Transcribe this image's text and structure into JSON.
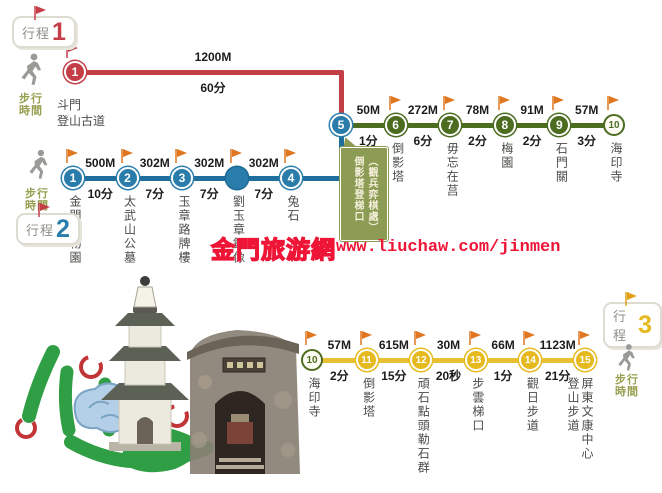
{
  "labels": {
    "route_prefix": "行程",
    "walk_time": "步行時間"
  },
  "colors": {
    "route1_red": "#c43e48",
    "route2_blue": "#2a7dab",
    "summit_green": "#4c6c20",
    "route3_yellow": "#e6ba1e",
    "flag_orange": "#e0761f",
    "walk_label_olive": "#97a050",
    "callout_olive": "#8c9c55",
    "watermark_red": "#ee1537"
  },
  "watermark": {
    "site": "金門旅游網",
    "url": "www.liuchaw.com/jinmen"
  },
  "route1": {
    "number": "1",
    "stop": {
      "number": "1",
      "name": "斗門\n登山古道"
    },
    "segment": {
      "distance": "1200M",
      "time": "60分"
    }
  },
  "route2": {
    "number": "2",
    "stops": [
      {
        "number": "1",
        "name": "金門植物園"
      },
      {
        "number": "2",
        "name": "太武山公墓"
      },
      {
        "number": "3",
        "name": "玉章路牌樓"
      },
      {
        "number": "",
        "style": "bluesolid",
        "name": "劉玉章銅像"
      },
      {
        "number": "4",
        "name": "兔石"
      }
    ],
    "segments": [
      {
        "distance": "500M",
        "time": "10分"
      },
      {
        "distance": "302M",
        "time": "7分"
      },
      {
        "distance": "302M",
        "time": "7分"
      },
      {
        "distance": "302M",
        "time": "7分"
      }
    ]
  },
  "summit_row": {
    "stops": [
      {
        "number": "5",
        "style": "blue",
        "flag": false,
        "name": ""
      },
      {
        "number": "6",
        "style": "green",
        "name": "倒影塔"
      },
      {
        "number": "7",
        "style": "green",
        "name": "毋忘在莒"
      },
      {
        "number": "8",
        "style": "green",
        "name": "梅園"
      },
      {
        "number": "9",
        "style": "green",
        "name": "石門關"
      },
      {
        "number": "10",
        "style": "outline",
        "name": "海印寺"
      }
    ],
    "segments": [
      {
        "distance": "50M",
        "time": "1分"
      },
      {
        "distance": "272M",
        "time": "6分"
      },
      {
        "distance": "78M",
        "time": "2分"
      },
      {
        "distance": "91M",
        "time": "2分"
      },
      {
        "distance": "57M",
        "time": "3分"
      }
    ],
    "callout": "（觀兵弈棋處）\n倒影塔登梯口"
  },
  "route3": {
    "number": "3",
    "stops": [
      {
        "number": "10",
        "style": "outline",
        "name": "海印寺"
      },
      {
        "number": "11",
        "style": "yellow",
        "name": "倒影塔"
      },
      {
        "number": "12",
        "style": "yellow",
        "name": "頑石點頭勒石群"
      },
      {
        "number": "13",
        "style": "yellow",
        "name": "步雲梯口"
      },
      {
        "number": "14",
        "style": "yellow",
        "name": "觀日步道"
      },
      {
        "number": "15",
        "style": "yellow",
        "name": "屏東文康中心\n登山步道"
      }
    ],
    "segments": [
      {
        "distance": "57M",
        "time": "2分"
      },
      {
        "distance": "615M",
        "time": "15分"
      },
      {
        "distance": "30M",
        "time": "20秒"
      },
      {
        "distance": "66M",
        "time": "1分"
      },
      {
        "distance": "1123M",
        "time": "21分"
      }
    ]
  }
}
